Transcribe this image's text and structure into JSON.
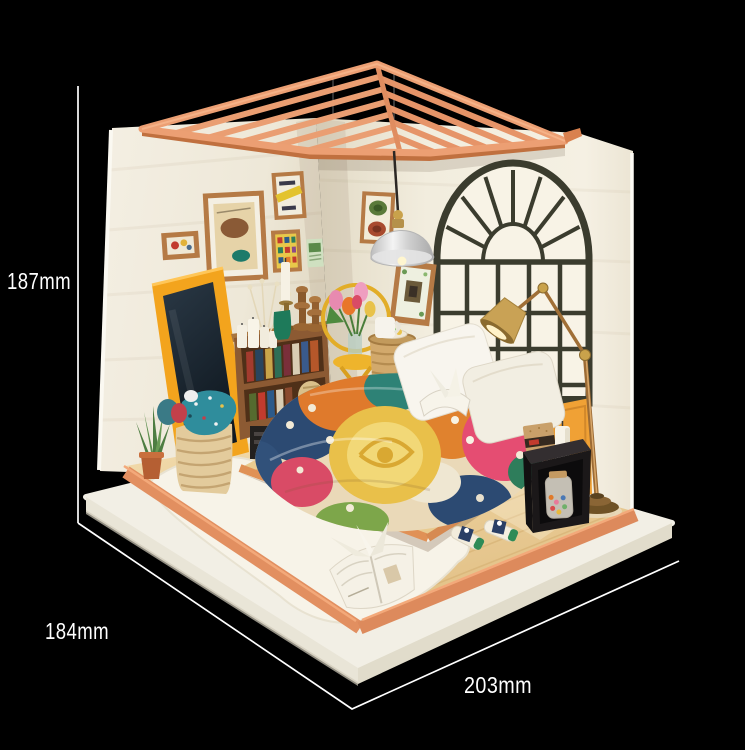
{
  "annotations": {
    "height_label": "187mm",
    "depth_label": "184mm",
    "width_label": "203mm"
  },
  "colors": {
    "background": "#000000",
    "dimension_lines": "#ffffff",
    "roof_salmon": "#ec9f73",
    "wall_cream": "#f1ecdf",
    "floor_wood": "#ecd0a0",
    "floor_trim_peach": "#e28f60",
    "base_platform_white": "#f2efe5",
    "window_frame": "#3b3c2e",
    "mirror_frame_yellow": "#f3a41d",
    "bookshelf_brown": "#8c5a33",
    "stool_yellow": "#eeb42c",
    "quilt_magenta": "#e54d72",
    "quilt_orange": "#df7a2c",
    "quilt_navy": "#2c4a72",
    "quilt_yellow": "#e9c04a",
    "lamp_copper": "#a06f36",
    "nightstand_black": "#1b1819"
  },
  "scene": {
    "objects": [
      "pergola slat roof",
      "cream wall panels",
      "arched window",
      "pendant lamp",
      "standing mirror",
      "picture frames",
      "bookshelf with books",
      "candles",
      "stool with tulips",
      "wicker basket",
      "laundry basket",
      "aloe plant",
      "platform bed with floral quilt",
      "white pillows",
      "suitcase",
      "black nightstand with candy jar",
      "floor lamp",
      "slippers",
      "open picture book",
      "white base platform"
    ]
  }
}
